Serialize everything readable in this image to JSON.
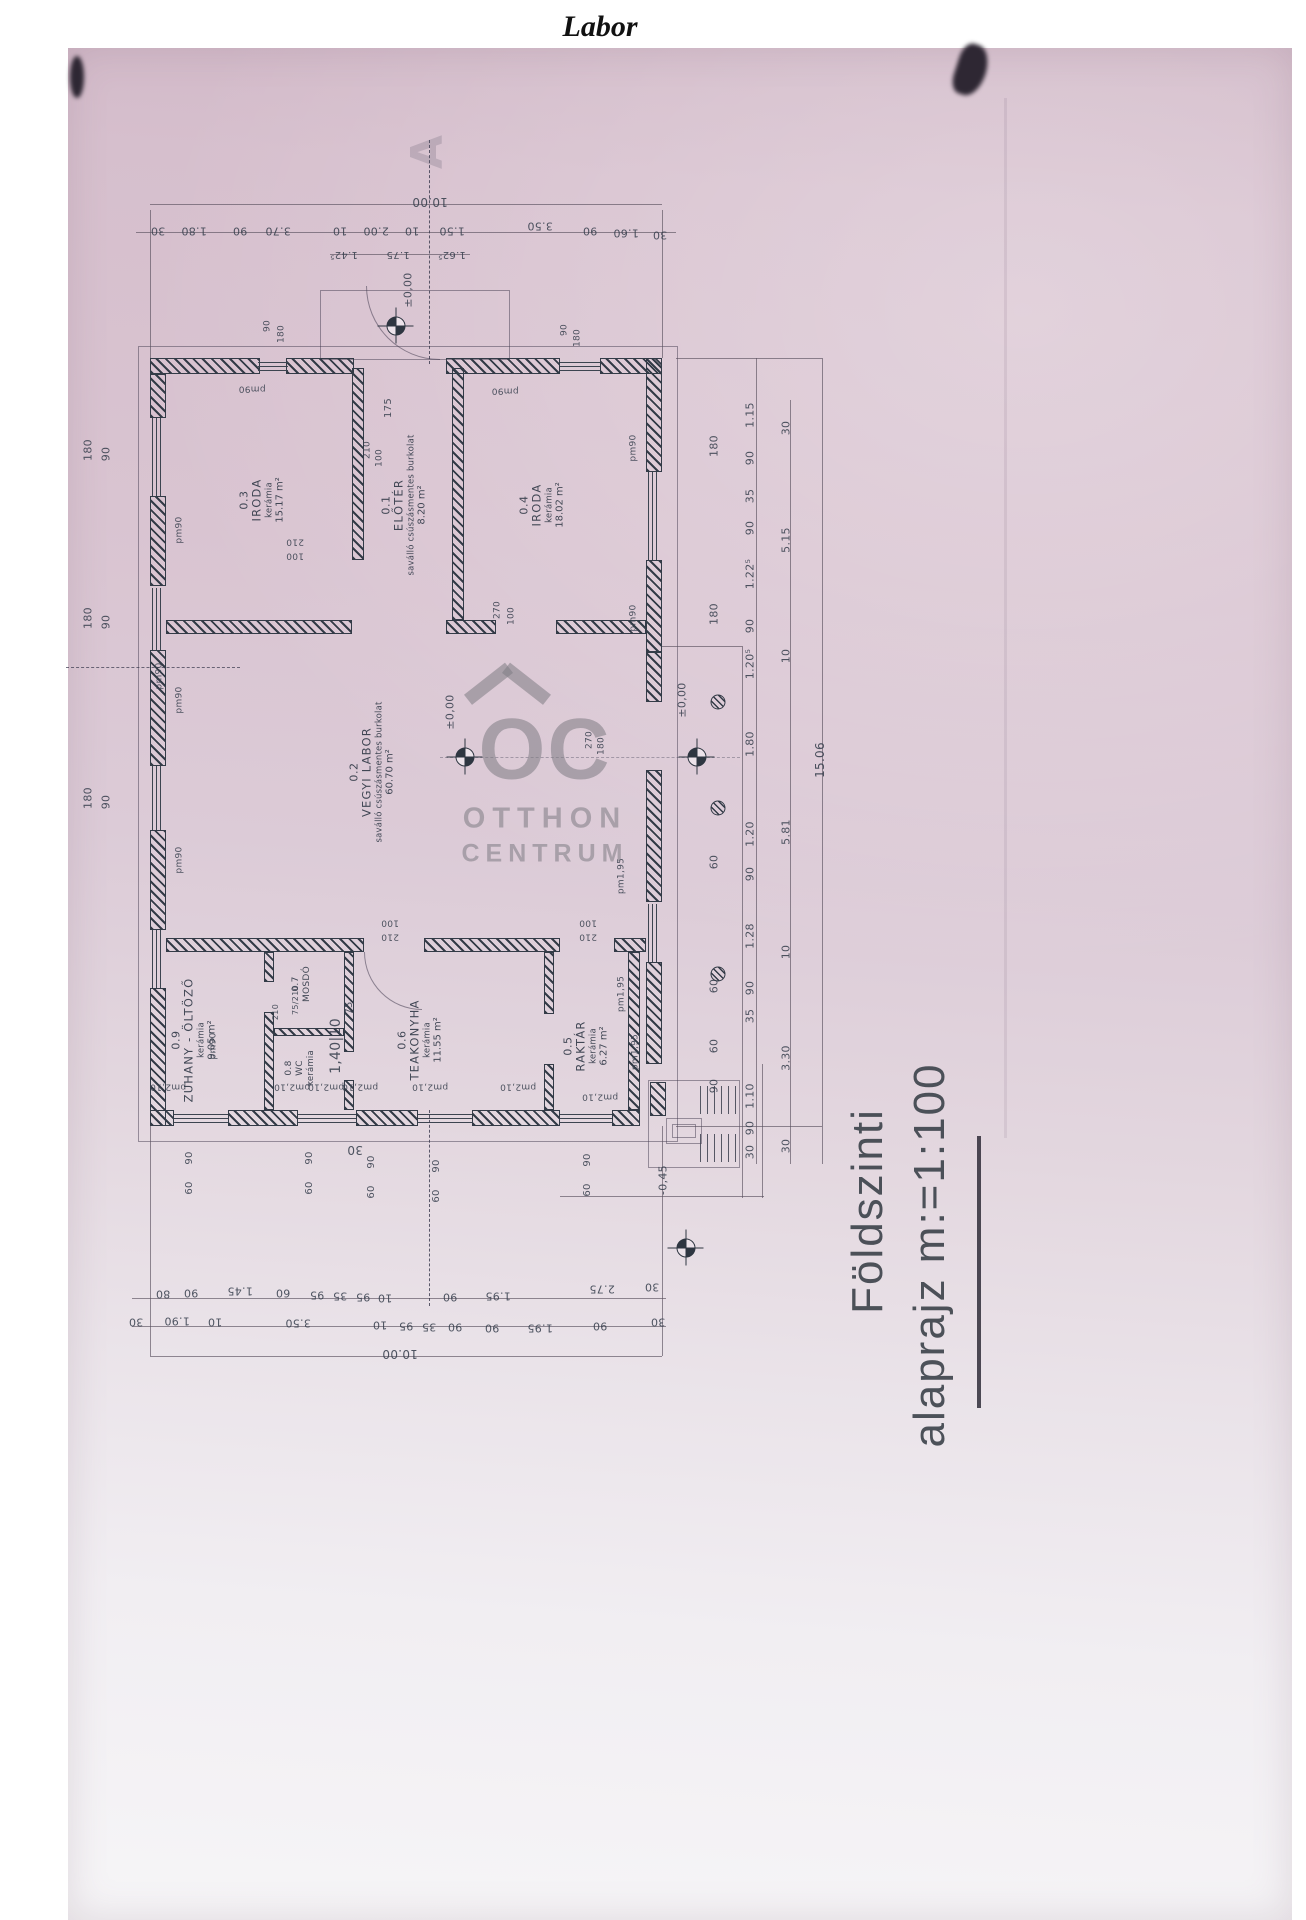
{
  "header": {
    "title": "Labor"
  },
  "caption": {
    "line1": "Földszinti",
    "line2": "alaprajz m:=1:100"
  },
  "watermark": {
    "monogram": "OC",
    "line1": "OTTHON",
    "line2": "CENTRUM"
  },
  "colors": {
    "ink": "#333b47",
    "paper": "#d9c4d1",
    "watermark_gray": "#7d7b84"
  },
  "plan": {
    "scale_note": "m:=1:100",
    "rooms": [
      {
        "num": "0.3",
        "name": "IRODA",
        "finish": "kerámia",
        "area": "15.17 m²",
        "x": 262,
        "y": 500
      },
      {
        "num": "0.1",
        "name": "ELŐTÉR",
        "finish": "saválló csúszásmentes burkolat",
        "area": "8.20 m²",
        "x": 404,
        "y": 505
      },
      {
        "num": "0.4",
        "name": "IRODA",
        "finish": "kerámia",
        "area": "18.02 m²",
        "x": 542,
        "y": 505
      },
      {
        "num": "0.2",
        "name": "VEGYI LABOR",
        "finish": "saválló csúszásmentes burkolat",
        "area": "60.70 m²",
        "x": 372,
        "y": 772
      },
      {
        "num": "0.9",
        "name": "ZUHANY - ÖLTÖZŐ",
        "finish": "kerámia",
        "area": "9.05 m²",
        "x": 194,
        "y": 1040
      },
      {
        "num": "0.7",
        "name": "MOSDÓ",
        "finish": "",
        "area": "",
        "x": 302,
        "y": 984,
        "small": true
      },
      {
        "num": "0.8",
        "name": "WC",
        "finish": "kerámia",
        "area": "",
        "x": 300,
        "y": 1068,
        "small": true
      },
      {
        "num": "0.6",
        "name": "TEAKONYHA",
        "finish": "kerámia",
        "area": "11.55 m²",
        "x": 420,
        "y": 1040
      },
      {
        "num": "0.5",
        "name": "RAKTÁR",
        "finish": "kerámia",
        "area": "6.27 m²",
        "x": 586,
        "y": 1046
      }
    ],
    "datums": [
      {
        "x": 396,
        "y": 326
      },
      {
        "x": 465,
        "y": 757
      },
      {
        "x": 697,
        "y": 757
      },
      {
        "x": 686,
        "y": 1248
      }
    ],
    "columns": [
      {
        "x": 718,
        "y": 702
      },
      {
        "x": 718,
        "y": 808
      },
      {
        "x": 718,
        "y": 974
      }
    ],
    "labels": [
      {
        "t": "10.00",
        "x": 430,
        "y": 202,
        "r": 180,
        "s": 12
      },
      {
        "t": "30",
        "x": 158,
        "y": 231,
        "r": 180
      },
      {
        "t": "1.80",
        "x": 194,
        "y": 231,
        "r": 180
      },
      {
        "t": "90",
        "x": 240,
        "y": 231,
        "r": 180
      },
      {
        "t": "3.70",
        "x": 278,
        "y": 231,
        "r": 180
      },
      {
        "t": "10",
        "x": 340,
        "y": 231,
        "r": 180
      },
      {
        "t": "2.00",
        "x": 376,
        "y": 231,
        "r": 180
      },
      {
        "t": "10",
        "x": 412,
        "y": 231,
        "r": 180
      },
      {
        "t": "1.50",
        "x": 452,
        "y": 231,
        "r": 180
      },
      {
        "t": "3.50",
        "x": 540,
        "y": 226,
        "r": 180
      },
      {
        "t": "90",
        "x": 590,
        "y": 231,
        "r": 180
      },
      {
        "t": "1.60",
        "x": 626,
        "y": 233,
        "r": 180
      },
      {
        "t": "30",
        "x": 660,
        "y": 235,
        "r": 180
      },
      {
        "t": "1.42⁵",
        "x": 344,
        "y": 254,
        "r": 180,
        "s": 10
      },
      {
        "t": "1.75",
        "x": 398,
        "y": 254,
        "r": 180,
        "s": 10
      },
      {
        "t": "1.62⁵",
        "x": 452,
        "y": 254,
        "r": 180,
        "s": 10
      },
      {
        "t": "80",
        "x": 163,
        "y": 1294,
        "r": 180
      },
      {
        "t": "90",
        "x": 191,
        "y": 1293,
        "r": 180
      },
      {
        "t": "1.45",
        "x": 240,
        "y": 1291,
        "r": 180
      },
      {
        "t": "60",
        "x": 283,
        "y": 1293,
        "r": 180
      },
      {
        "t": "95",
        "x": 317,
        "y": 1295,
        "r": 180
      },
      {
        "t": "35",
        "x": 340,
        "y": 1296,
        "r": 180
      },
      {
        "t": "95",
        "x": 363,
        "y": 1297,
        "r": 180
      },
      {
        "t": "10",
        "x": 385,
        "y": 1298,
        "r": 180
      },
      {
        "t": "90",
        "x": 450,
        "y": 1297,
        "r": 180
      },
      {
        "t": "1.95",
        "x": 498,
        "y": 1296,
        "r": 180
      },
      {
        "t": "2.75",
        "x": 602,
        "y": 1289,
        "r": 180
      },
      {
        "t": "30",
        "x": 652,
        "y": 1287,
        "r": 180
      },
      {
        "t": "30",
        "x": 136,
        "y": 1322,
        "r": 180
      },
      {
        "t": "1.90",
        "x": 177,
        "y": 1321,
        "r": 180
      },
      {
        "t": "10",
        "x": 215,
        "y": 1322,
        "r": 180
      },
      {
        "t": "3.50",
        "x": 298,
        "y": 1323,
        "r": 180
      },
      {
        "t": "10",
        "x": 380,
        "y": 1325,
        "r": 180
      },
      {
        "t": "95",
        "x": 406,
        "y": 1326,
        "r": 180
      },
      {
        "t": "35",
        "x": 429,
        "y": 1327,
        "r": 180
      },
      {
        "t": "90",
        "x": 455,
        "y": 1327,
        "r": 180
      },
      {
        "t": "90",
        "x": 492,
        "y": 1328,
        "r": 180
      },
      {
        "t": "1.95",
        "x": 540,
        "y": 1328,
        "r": 180
      },
      {
        "t": "90",
        "x": 600,
        "y": 1326,
        "r": 180
      },
      {
        "t": "30",
        "x": 658,
        "y": 1322,
        "r": 180
      },
      {
        "t": "10.00",
        "x": 400,
        "y": 1354,
        "r": 180,
        "s": 12
      },
      {
        "t": "1.15",
        "x": 750,
        "y": 415,
        "r": -90
      },
      {
        "t": "90",
        "x": 750,
        "y": 458,
        "r": -90
      },
      {
        "t": "35",
        "x": 750,
        "y": 496,
        "r": -90
      },
      {
        "t": "90",
        "x": 750,
        "y": 528,
        "r": -90
      },
      {
        "t": "1.22⁵",
        "x": 750,
        "y": 574,
        "r": -90
      },
      {
        "t": "90",
        "x": 750,
        "y": 626,
        "r": -90
      },
      {
        "t": "1.20⁵",
        "x": 750,
        "y": 664,
        "r": -90
      },
      {
        "t": "1.80",
        "x": 750,
        "y": 744,
        "r": -90
      },
      {
        "t": "1.20",
        "x": 750,
        "y": 834,
        "r": -90
      },
      {
        "t": "90",
        "x": 750,
        "y": 874,
        "r": -90
      },
      {
        "t": "1.28",
        "x": 750,
        "y": 936,
        "r": -90
      },
      {
        "t": "90",
        "x": 750,
        "y": 988,
        "r": -90
      },
      {
        "t": "35",
        "x": 750,
        "y": 1016,
        "r": -90
      },
      {
        "t": "1.10",
        "x": 750,
        "y": 1096,
        "r": -90
      },
      {
        "t": "90",
        "x": 750,
        "y": 1128,
        "r": -90
      },
      {
        "t": "30",
        "x": 750,
        "y": 1152,
        "r": -90
      },
      {
        "t": "180",
        "x": 714,
        "y": 446,
        "r": -90
      },
      {
        "t": "180",
        "x": 714,
        "y": 614,
        "r": -90
      },
      {
        "t": "60",
        "x": 714,
        "y": 862,
        "r": -90
      },
      {
        "t": "60",
        "x": 714,
        "y": 986,
        "r": -90
      },
      {
        "t": "60",
        "x": 714,
        "y": 1046,
        "r": -90
      },
      {
        "t": "90",
        "x": 714,
        "y": 1086,
        "r": -90
      },
      {
        "t": "30",
        "x": 786,
        "y": 428,
        "r": -90
      },
      {
        "t": "5.15",
        "x": 786,
        "y": 540,
        "r": -90
      },
      {
        "t": "10",
        "x": 786,
        "y": 656,
        "r": -90
      },
      {
        "t": "5.81",
        "x": 786,
        "y": 832,
        "r": -90
      },
      {
        "t": "10",
        "x": 786,
        "y": 952,
        "r": -90
      },
      {
        "t": "3.30",
        "x": 786,
        "y": 1058,
        "r": -90
      },
      {
        "t": "30",
        "x": 786,
        "y": 1146,
        "r": -90
      },
      {
        "t": "15.06",
        "x": 820,
        "y": 760,
        "r": -90,
        "s": 12
      },
      {
        "t": "180",
        "x": 88,
        "y": 450,
        "r": -90
      },
      {
        "t": "90",
        "x": 106,
        "y": 454,
        "r": -90
      },
      {
        "t": "180",
        "x": 88,
        "y": 618,
        "r": -90
      },
      {
        "t": "90",
        "x": 106,
        "y": 622,
        "r": -90
      },
      {
        "t": "180",
        "x": 88,
        "y": 798,
        "r": -90
      },
      {
        "t": "90",
        "x": 106,
        "y": 802,
        "r": -90
      },
      {
        "t": "90",
        "x": 190,
        "y": 1158,
        "r": -90,
        "s": 10
      },
      {
        "t": "60",
        "x": 190,
        "y": 1188,
        "r": -90,
        "s": 10
      },
      {
        "t": "90",
        "x": 310,
        "y": 1158,
        "r": -90,
        "s": 10
      },
      {
        "t": "60",
        "x": 310,
        "y": 1188,
        "r": -90,
        "s": 10
      },
      {
        "t": "90",
        "x": 372,
        "y": 1162,
        "r": -90,
        "s": 10
      },
      {
        "t": "60",
        "x": 372,
        "y": 1192,
        "r": -90,
        "s": 10
      },
      {
        "t": "90",
        "x": 437,
        "y": 1166,
        "r": -90,
        "s": 10
      },
      {
        "t": "60",
        "x": 437,
        "y": 1196,
        "r": -90,
        "s": 10
      },
      {
        "t": "90",
        "x": 588,
        "y": 1160,
        "r": -90,
        "s": 10
      },
      {
        "t": "60",
        "x": 588,
        "y": 1190,
        "r": -90,
        "s": 10
      },
      {
        "t": "30",
        "x": 355,
        "y": 1150,
        "r": 180,
        "s": 12
      },
      {
        "t": "pm90",
        "x": 252,
        "y": 388,
        "r": 180,
        "s": 9
      },
      {
        "t": "pm90",
        "x": 505,
        "y": 390,
        "r": 180,
        "s": 9
      },
      {
        "t": "pm90",
        "x": 634,
        "y": 448,
        "r": -90,
        "s": 9
      },
      {
        "t": "pm90",
        "x": 634,
        "y": 618,
        "r": -90,
        "s": 9
      },
      {
        "t": "pm90",
        "x": 180,
        "y": 530,
        "r": -90,
        "s": 9
      },
      {
        "t": "pm90",
        "x": 180,
        "y": 700,
        "r": -90,
        "s": 9
      },
      {
        "t": "pm90",
        "x": 180,
        "y": 860,
        "r": -90,
        "s": 9
      },
      {
        "t": "pm90",
        "x": 160,
        "y": 676,
        "r": -90,
        "s": 9
      },
      {
        "t": "pm90",
        "x": 214,
        "y": 1046,
        "r": -90,
        "s": 9
      },
      {
        "t": "pm1,95",
        "x": 622,
        "y": 876,
        "r": -90,
        "s": 9
      },
      {
        "t": "pm1,95",
        "x": 622,
        "y": 994,
        "r": -90,
        "s": 9
      },
      {
        "t": "pm1,95",
        "x": 636,
        "y": 1052,
        "r": -90,
        "s": 9
      },
      {
        "t": "pm2,10",
        "x": 168,
        "y": 1086,
        "r": 180,
        "s": 9
      },
      {
        "t": "pm2,10",
        "x": 292,
        "y": 1086,
        "r": 180,
        "s": 9
      },
      {
        "t": "pm2,10",
        "x": 326,
        "y": 1086,
        "r": 180,
        "s": 9
      },
      {
        "t": "pm2,10",
        "x": 360,
        "y": 1086,
        "r": 180,
        "s": 9
      },
      {
        "t": "pm2,10",
        "x": 430,
        "y": 1086,
        "r": 180,
        "s": 9
      },
      {
        "t": "pm2,10",
        "x": 518,
        "y": 1086,
        "r": 180,
        "s": 9
      },
      {
        "t": "pm2,10",
        "x": 600,
        "y": 1096,
        "r": 180,
        "s": 9
      },
      {
        "t": "210",
        "x": 295,
        "y": 541,
        "r": 180,
        "s": 9
      },
      {
        "t": "100",
        "x": 295,
        "y": 555,
        "r": 180,
        "s": 9
      },
      {
        "t": "210",
        "x": 368,
        "y": 450,
        "r": -90,
        "s": 9
      },
      {
        "t": "100",
        "x": 380,
        "y": 458,
        "r": -90,
        "s": 9
      },
      {
        "t": "270",
        "x": 498,
        "y": 610,
        "r": -90,
        "s": 9
      },
      {
        "t": "100",
        "x": 512,
        "y": 616,
        "r": -90,
        "s": 9
      },
      {
        "t": "270",
        "x": 590,
        "y": 740,
        "r": -90,
        "s": 9
      },
      {
        "t": "180",
        "x": 602,
        "y": 746,
        "r": -90,
        "s": 9
      },
      {
        "t": "100",
        "x": 390,
        "y": 922,
        "r": 180,
        "s": 9
      },
      {
        "t": "210",
        "x": 390,
        "y": 936,
        "r": 180,
        "s": 9
      },
      {
        "t": "100",
        "x": 588,
        "y": 922,
        "r": 180,
        "s": 9
      },
      {
        "t": "210",
        "x": 588,
        "y": 936,
        "r": 180,
        "s": 9
      },
      {
        "t": "175",
        "x": 389,
        "y": 408,
        "r": -90,
        "s": 10
      },
      {
        "t": "90",
        "x": 268,
        "y": 326,
        "r": -90,
        "s": 9
      },
      {
        "t": "180",
        "x": 282,
        "y": 334,
        "r": -90,
        "s": 9
      },
      {
        "t": "90",
        "x": 565,
        "y": 330,
        "r": -90,
        "s": 9
      },
      {
        "t": "180",
        "x": 578,
        "y": 338,
        "r": -90,
        "s": 9
      },
      {
        "t": "75/210",
        "x": 296,
        "y": 1000,
        "r": -90,
        "s": 8
      },
      {
        "t": "210",
        "x": 276,
        "y": 1012,
        "r": -90,
        "s": 8
      },
      {
        "t": "1,40|10",
        "x": 336,
        "y": 1046,
        "r": -90,
        "s": 14
      },
      {
        "t": "75",
        "x": 350,
        "y": 1008,
        "r": -90,
        "s": 10
      },
      {
        "t": "±0,00",
        "x": 408,
        "y": 290,
        "r": -90,
        "s": 11
      },
      {
        "t": "±0,00",
        "x": 450,
        "y": 712,
        "r": -90,
        "s": 11
      },
      {
        "t": "±0,00",
        "x": 682,
        "y": 700,
        "r": -90,
        "s": 11
      },
      {
        "t": "-0,45",
        "x": 663,
        "y": 1180,
        "r": -90,
        "s": 11
      },
      {
        "t": "A",
        "x": 428,
        "y": 152,
        "r": -90,
        "s": 44,
        "c": "ghost",
        "n": "section-marker-a"
      }
    ]
  }
}
